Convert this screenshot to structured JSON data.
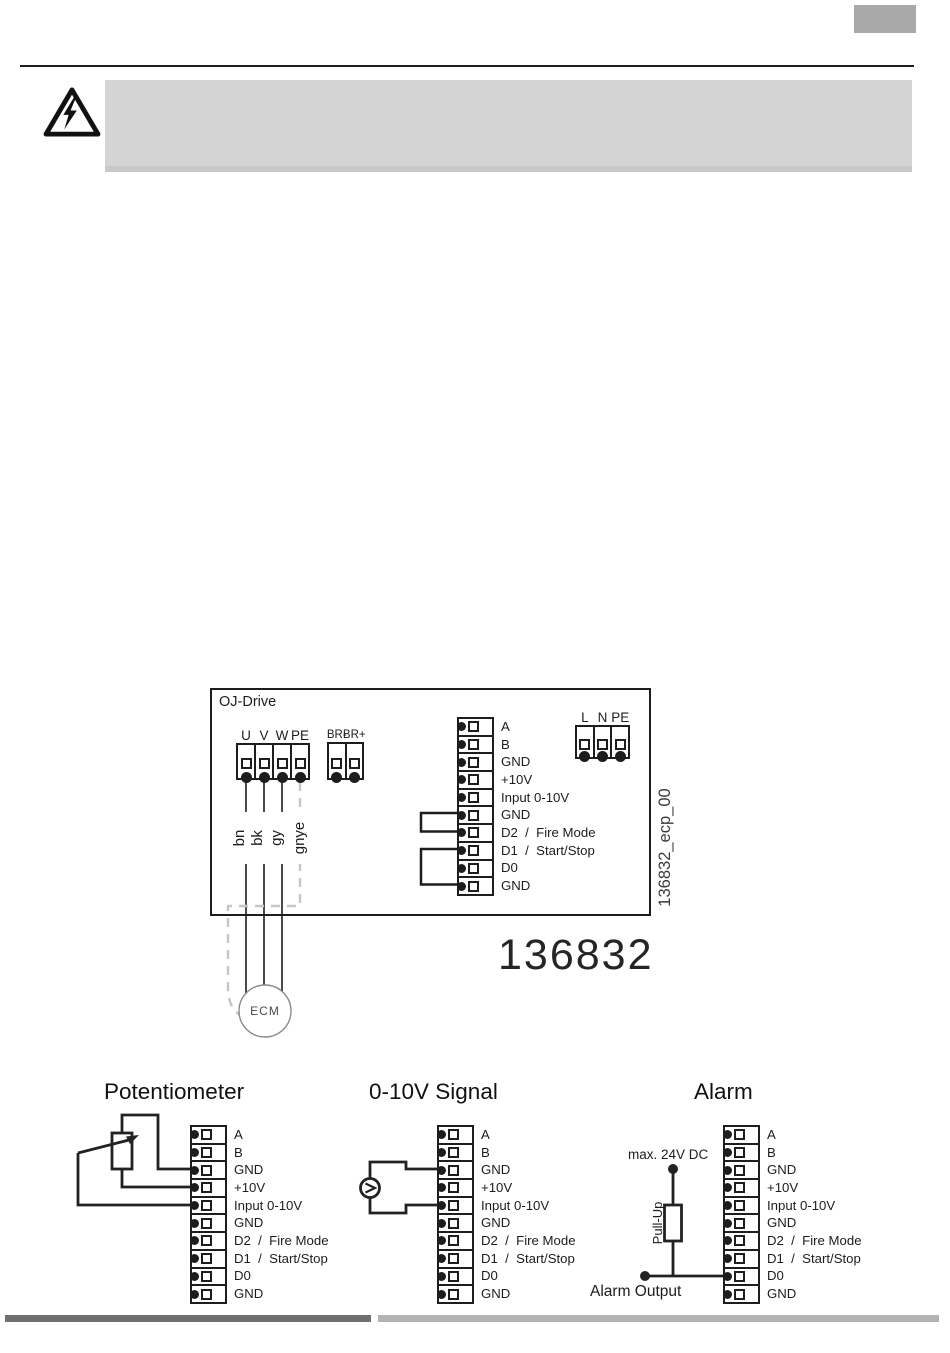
{
  "diagram": {
    "label": "OJ-Drive",
    "part_number": "136832",
    "file_ref": "136832_ecp_00",
    "motor_label": "ECM",
    "motor_terminals": [
      "U",
      "V",
      "W",
      "PE"
    ],
    "brake_terminals": [
      "BR-",
      "BR+"
    ],
    "mains_terminals": [
      "L",
      "N",
      "PE"
    ],
    "control_terminals": [
      "A",
      "B",
      "GND",
      "+10V",
      "Input 0-10V",
      "GND",
      "D2  /  Fire Mode",
      "D1  /  Start/Stop",
      "D0",
      "GND"
    ],
    "wire_labels": [
      "bn",
      "bk",
      "gy",
      "gnye"
    ]
  },
  "examples": {
    "potentiometer": {
      "title": "Potentiometer"
    },
    "signal": {
      "title": "0-10V Signal"
    },
    "alarm": {
      "title": "Alarm",
      "supply_label": "max. 24V DC",
      "resistor_label": "Pull-Up",
      "output_label": "Alarm Output"
    }
  },
  "colors": {
    "line": "#1d1d1d",
    "wire": "#4a4a4a",
    "pe_wire_dashed": "#c6c6c6",
    "warning_panel": "#d4d4d4",
    "corner_box": "#a9a9a9",
    "footer_bar_dark": "#6f6f6f",
    "footer_bar_light": "#b3b3b3"
  }
}
